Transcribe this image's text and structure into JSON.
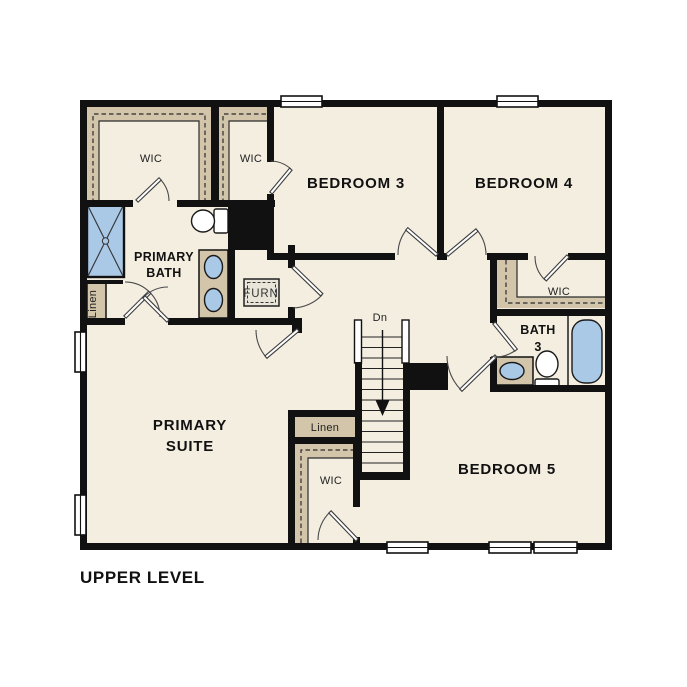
{
  "page": {
    "title": "UPPER LEVEL"
  },
  "colors": {
    "floor": "#f4eee1",
    "closet": "#d2c5aa",
    "wall": "#111111",
    "fixture": "#aac9e6",
    "background": "#ffffff"
  },
  "labels": {
    "wic_primary": "WIC",
    "wic_bedroom3": "WIC",
    "bedroom3": "BEDROOM 3",
    "bedroom4": "BEDROOM 4",
    "bedroom5": "BEDROOM 5",
    "primary_bath_1": "PRIMARY",
    "primary_bath_2": "BATH",
    "linen_bath": "Linen",
    "furnace": "FURN",
    "wic_bedroom4": "WIC",
    "bath3_1": "BATH",
    "bath3_2": "3",
    "stairs_down": "Dn",
    "primary_suite_1": "PRIMARY",
    "primary_suite_2": "SUITE",
    "linen_hall": "Linen",
    "wic_bedroom5": "WIC"
  }
}
